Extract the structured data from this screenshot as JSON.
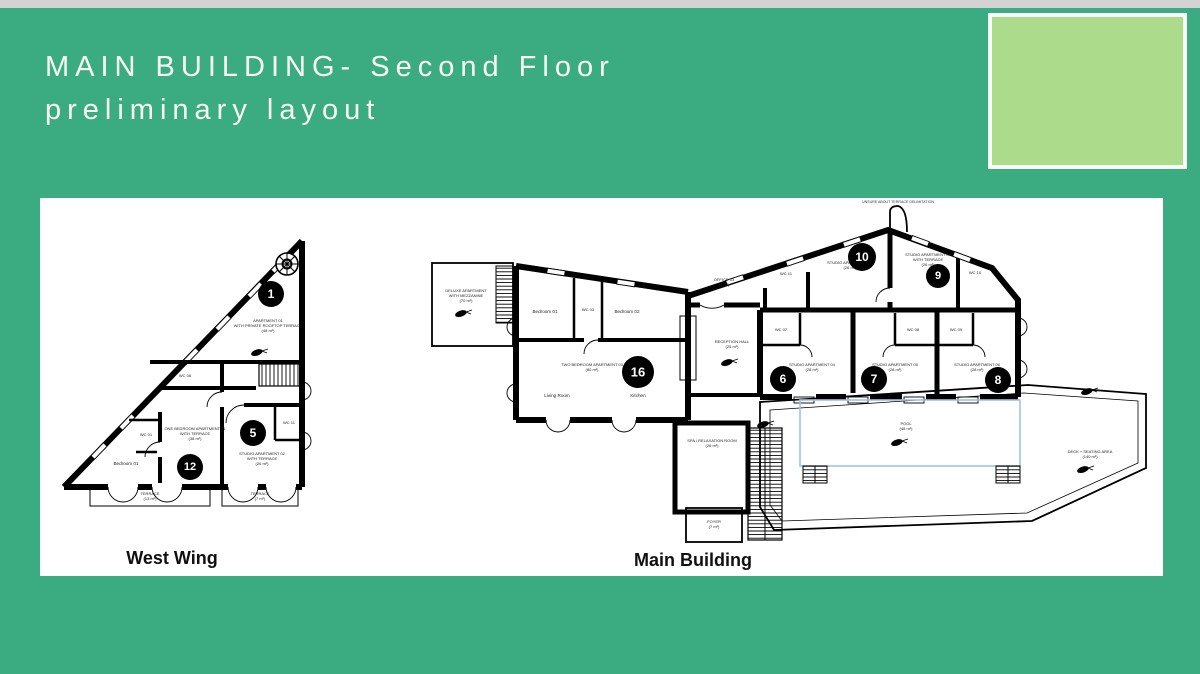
{
  "slide": {
    "title": {
      "line1": "MAIN BUILDING- Second Floor",
      "line2": "preliminary layout"
    },
    "colors": {
      "background": "#3BAC81",
      "accent_square": "#ABDB8B",
      "top_strip": "#D3D3D3",
      "panel": "#FFFFFF",
      "pool_outline": "#9DC3E6",
      "marker": "#000000",
      "title_text": "#F8FBF4"
    }
  },
  "west": {
    "caption": "West Wing",
    "markers": {
      "m1": "1",
      "m5": "5",
      "m12": "12"
    },
    "apartment1": {
      "l1": "APARTMENT 01",
      "l2": "WITH PRIVATE ROOFTOP TERRACE",
      "l3": "(48 m²)"
    },
    "one_bedroom": {
      "l1": "ONE BEDROOM APARTMENT 01",
      "l2": "WITH TERRACE",
      "l3": "(38 m²)"
    },
    "studio02": {
      "l1": "STUDIO APARTMENT 02",
      "l2": "WITH TERRACE",
      "l3": "(26 m²)"
    },
    "rooms": {
      "wc06": "WC 06",
      "wc01": "WC 01",
      "wc11": "WC 11",
      "bedroom01": "Bedroom 01"
    },
    "terrace_left": {
      "l1": "TERRACE",
      "l2": "(13 m²)"
    },
    "terrace_right": {
      "l1": "TERRACE",
      "l2": "(7 m²)"
    }
  },
  "main": {
    "caption": "Main Building",
    "annotation": "UNSURE ABOUT TERRACE DELIMITATION",
    "markers": {
      "m6": "6",
      "m7": "7",
      "m8": "8",
      "m9": "9",
      "m10": "10",
      "m16": "16"
    },
    "deluxe": {
      "l1": "DELUXE APARTMENT",
      "l2": "WITH MEZZANINE",
      "l3": "(70 m²)"
    },
    "rooms": {
      "bedroom01": "Bedroom 01",
      "wc03": "WC 03",
      "bedroom02": "Bedroom 02",
      "living": "Living Room",
      "kitchen": "Kitchen",
      "wc11": "WC 11",
      "wc10": "WC 10",
      "wc07": "WC 07",
      "wc08": "WC 08",
      "wc09": "WC 09"
    },
    "two_bedroom": {
      "l1": "TWO BEDROOM APARTMENT 03",
      "l2": "(80 m²)"
    },
    "reception": {
      "l1": "RECEPTION HALL",
      "l2": "(25 m²)"
    },
    "office": {
      "l1": "OFFICE 03",
      "l2": "(9 m²)"
    },
    "studio08": {
      "l1": "STUDIO APARTMENT 08",
      "l2": "(26 m²)"
    },
    "studio07": {
      "l1": "STUDIO APARTMENT 07",
      "l2": "WITH TERRACE",
      "l3": "(26 m²)"
    },
    "studio04": {
      "l1": "STUDIO APARTMENT 04",
      "l2": "(28 m²)"
    },
    "studio05": {
      "l1": "STUDIO APARTMENT 05",
      "l2": "(28 m²)"
    },
    "studio06": {
      "l1": "STUDIO APARTMENT 06",
      "l2": "(28 m²)"
    },
    "spa": {
      "l1": "SPA / RELAXATION ROOM",
      "l2": "(28 m²)"
    },
    "foyer": {
      "l1": "FOYER",
      "l2": "(7 m²)"
    },
    "pool": {
      "l1": "POOL",
      "l2": "(48 m²)"
    },
    "deck": {
      "l1": "DECK + SEATING AREA",
      "l2": "(140 m²)"
    }
  }
}
